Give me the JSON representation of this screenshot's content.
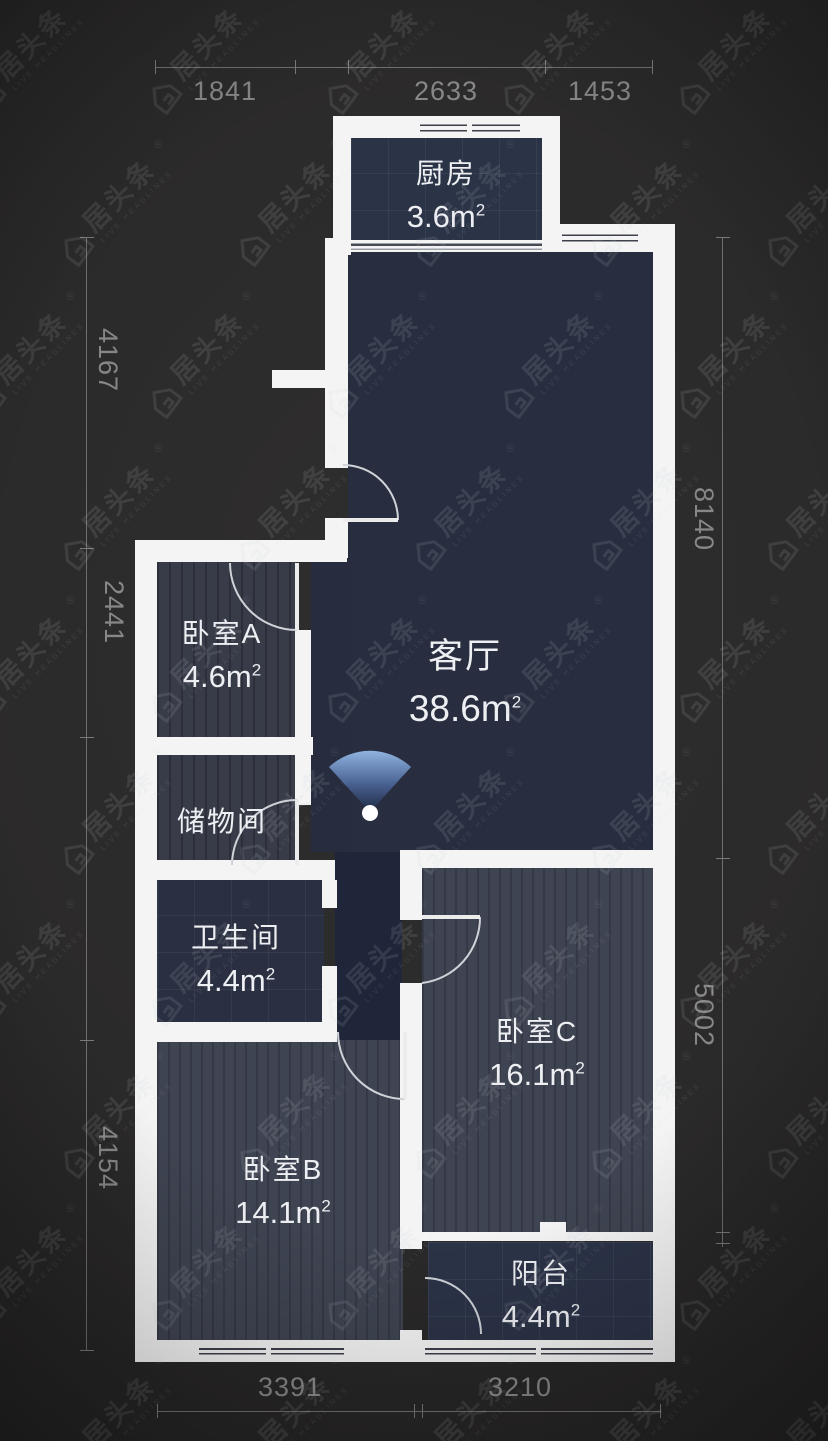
{
  "watermark": {
    "brand": "居头条",
    "subtitle": "LIVE HEADLINES",
    "registered": "®"
  },
  "rooms": {
    "kitchen": {
      "name": "厨房",
      "area": "3.6m",
      "sup": "2"
    },
    "living": {
      "name": "客厅",
      "area": "38.6m",
      "sup": "2"
    },
    "bedroom_a": {
      "name": "卧室A",
      "area": "4.6m",
      "sup": "2"
    },
    "storage": {
      "name": "储物间"
    },
    "bathroom": {
      "name": "卫生间",
      "area": "4.4m",
      "sup": "2"
    },
    "bedroom_b": {
      "name": "卧室B",
      "area": "14.1m",
      "sup": "2"
    },
    "bedroom_c": {
      "name": "卧室C",
      "area": "16.1m",
      "sup": "2"
    },
    "balcony": {
      "name": "阳台",
      "area": "4.4m",
      "sup": "2"
    }
  },
  "dimensions": {
    "top": [
      "1841",
      "2633",
      "1453"
    ],
    "bottom": [
      "3391",
      "3210"
    ],
    "left": [
      "4167",
      "2441",
      "4154"
    ],
    "right": [
      "8140",
      "5002"
    ]
  },
  "colors": {
    "background": "#2b2a2a",
    "wall": "#f4f4f4",
    "living_fill": "#282e3f",
    "kitchen_fill": "#2b3347",
    "bathroom_fill": "#2a3041",
    "bedroom_small_fill": "#383c49",
    "bedroom_large_fill": "#3f4452",
    "corridor_fill": "#202639",
    "balcony_fill": "#2b3347",
    "dimension_text": "#878787",
    "room_text": "#edeff2",
    "camera_fan": "#7fa4d6"
  }
}
